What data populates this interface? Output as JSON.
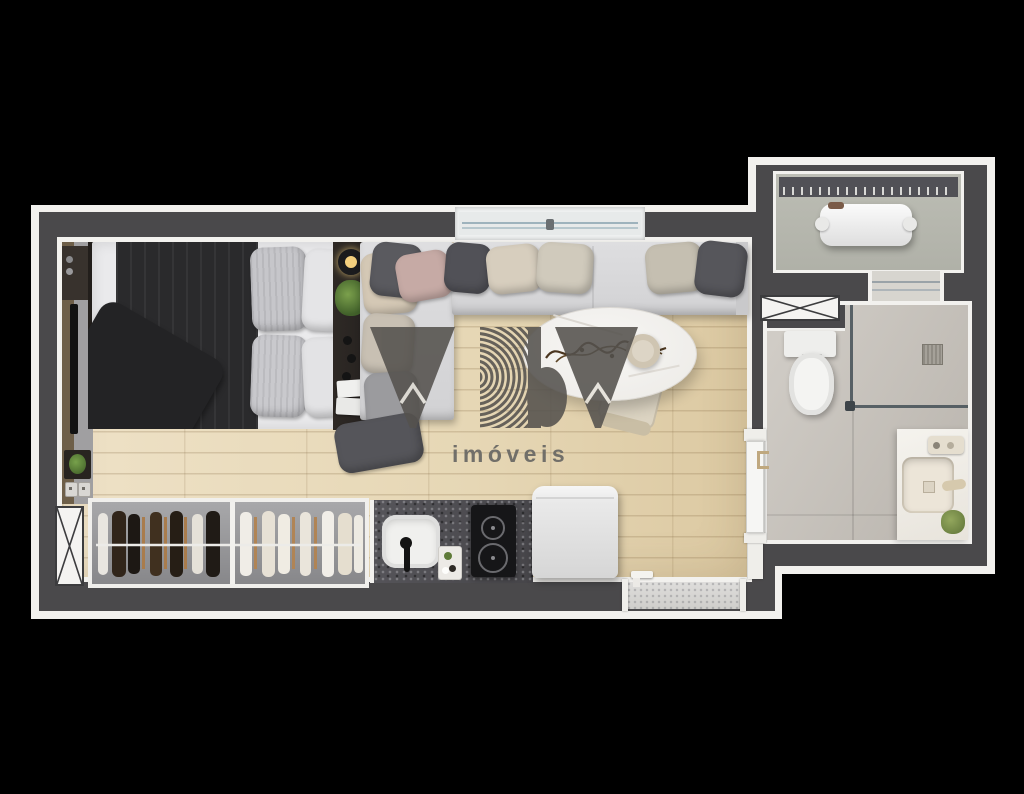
{
  "watermark": {
    "logo_text": "YBY",
    "subtitle": "imóveis"
  },
  "plan": {
    "view": "top-down 3D render of a studio apartment floor plan on a black background",
    "rooms": [
      {
        "name": "living-sleeping-area",
        "items": [
          "double bed with dark gray duvet and four pillows",
          "media wall with wall-mounted TV, framed plant and light switches",
          "nightstand shelf with pendant lamp, plant, knobs and cards",
          "L-shaped sofa with back cushions and chaise",
          "oval white marble dining table with branch centerpiece and round vase",
          "upholstered dining chair",
          "sliding window in top wall"
        ]
      },
      {
        "name": "kitchen",
        "items": [
          "dark speckled stone countertop",
          "white rounded sink with black faucet",
          "accessory tray",
          "two-burner black cooktop",
          "white refrigerator"
        ]
      },
      {
        "name": "closet",
        "items": [
          "open wardrobe with center divider and hanging rail",
          "dark garments section",
          "light garments section"
        ]
      },
      {
        "name": "bathroom",
        "items": [
          "toilet",
          "corner shower with glass enclosure and square floor drain",
          "white marble vanity with square basin, faucet set and small plant",
          "white sliding pocket door"
        ]
      },
      {
        "name": "service-area",
        "items": [
          "louvered vent wall",
          "white appliance unit"
        ]
      },
      {
        "name": "entry",
        "items": [
          "stone entry threshold with door handle"
        ]
      }
    ],
    "symbols": [
      "crossed duct shaft left wall",
      "crossed duct shaft right wall",
      "door threshold between service area and bathroom"
    ]
  },
  "colors": {
    "background": "#000000",
    "walls": "#4a494b",
    "outer_trim": "#f2f1ee",
    "wood_floor": "#e8dcbf",
    "bathroom_floor": "#c8c4be",
    "service_floor": "#b6b7ae",
    "wardrobe_interior": "#97979a",
    "sofa": "#d8d8da",
    "bed_duvet": "#29292b",
    "countertop": "#4e4d50",
    "marble": "#f2f1ef",
    "watermark_logo": "#55524e",
    "watermark_text": "#6b6a66"
  }
}
